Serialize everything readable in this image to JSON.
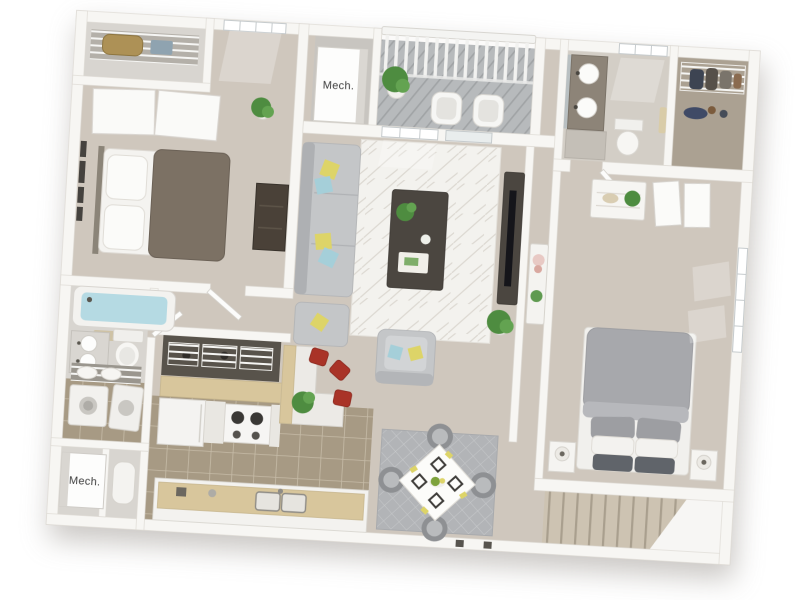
{
  "labels": {
    "mech_top": "Mech.",
    "mech_bottom": "Mech."
  },
  "palette": {
    "background": "#ffffff",
    "wall": "#f7f6f3",
    "wall_shadow": "#dbd7d1",
    "floor_main": "#cfc7bd",
    "floor_light": "#d8d5d0",
    "tile": "#a79a84",
    "tile_grout": "#c6bba7",
    "counter_tan": "#d8c69c",
    "cabinet": "#f3f2ef",
    "sofa_gray": "#c4c6c8",
    "rug_white": "#f3f2ee",
    "rug_gray": "#b2b4b7",
    "bed_gray": "#a7a8ac",
    "dark_wood": "#4b4640",
    "stool_red": "#a93327",
    "plant_green": "#4e8c40",
    "pillow_yellow": "#ddd468",
    "pillow_blue": "#a5cfd9",
    "water_blue": "#b5dae3",
    "stairs_tan": "#cdc3b2",
    "deck_gray": "#b7babc",
    "label_text": "#3b3b3b"
  }
}
